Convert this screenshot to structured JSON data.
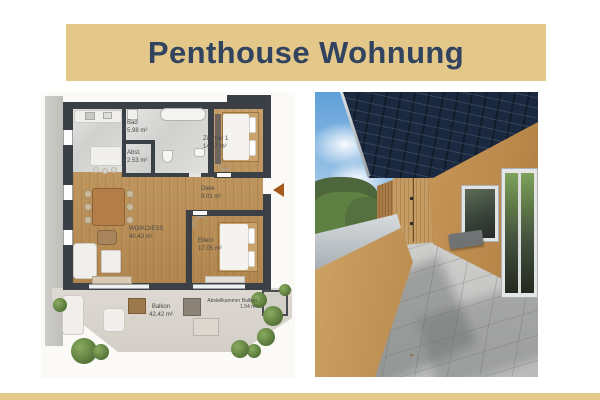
{
  "header": {
    "title": "Penthouse Wohnung"
  },
  "theme": {
    "banner_bg": "#e3c88a",
    "banner_text": "#31435f",
    "footer_strip": "#e3c88a",
    "plan_wall": "#3b4046",
    "entrance_arrow": "#a85a1d",
    "awning_navy": "#1b2940",
    "facade_ochre": "#bf8f4e"
  },
  "floor_plan": {
    "rooms": [
      {
        "id": "bad",
        "label": "Bad",
        "area": "5.98 m²"
      },
      {
        "id": "abst",
        "label": "Abst.",
        "area": "2.53 m²"
      },
      {
        "id": "zimmer1",
        "label": "Zimmer 1",
        "area": "14.57 m²"
      },
      {
        "id": "diele",
        "label": "Diele",
        "area": "9.01 m²"
      },
      {
        "id": "wohn_ess",
        "label": "WO/KO/ESS",
        "area": "40.43 m²"
      },
      {
        "id": "eltern",
        "label": "Eltern",
        "area": "17.05 m²"
      },
      {
        "id": "balkon",
        "label": "Balkon",
        "area": "42.42 m²"
      },
      {
        "id": "abstellkammer_balkon",
        "label": "Abstellkammer Balkon",
        "area": "1.54 m²"
      }
    ]
  }
}
